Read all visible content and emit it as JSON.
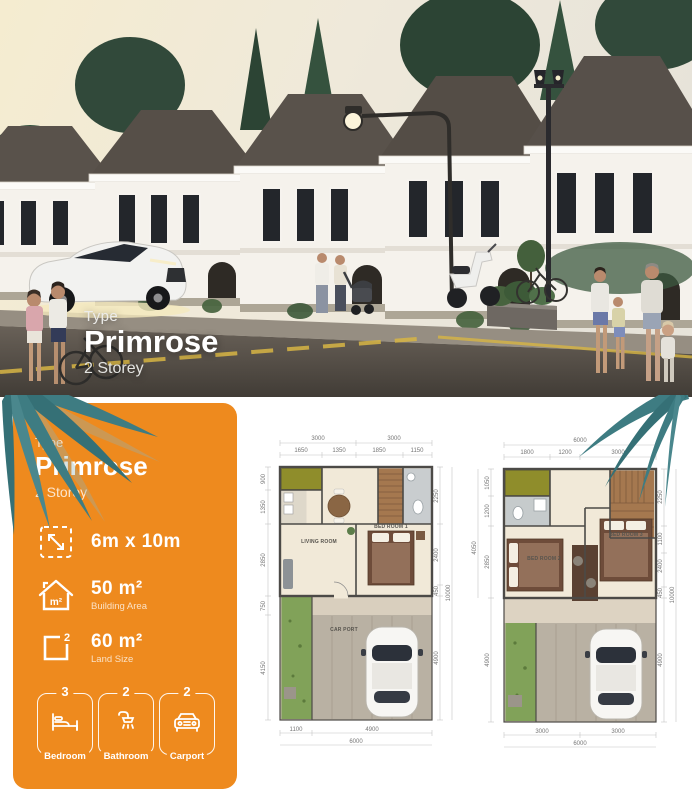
{
  "photo": {
    "overlay": {
      "type_label": "Type",
      "name": "Primrose",
      "storey": "2 Storey"
    }
  },
  "card": {
    "type_label": "Type",
    "name": "Primrose",
    "storey": "2 Storey",
    "size": {
      "value": "6m x 10m"
    },
    "building_area": {
      "value": "50 m²",
      "label": "Building Area"
    },
    "land_size": {
      "value": "60 m²",
      "label": "Land Size"
    },
    "icons": {
      "house_unit": "m²",
      "land_sup": "2"
    },
    "badges": [
      {
        "count": "3",
        "label": "Bedroom",
        "icon": "bed-icon"
      },
      {
        "count": "2",
        "label": "Bathroom",
        "icon": "shower-icon"
      },
      {
        "count": "2",
        "label": "Carport",
        "icon": "car-icon"
      }
    ],
    "colors": {
      "accent": "#EE8A1E",
      "leaf_teal": "#3E7C82"
    }
  },
  "plan1": {
    "rooms": {
      "living_room": "LIVING ROOM",
      "bed_room_1": "BED ROOM 1",
      "car_port": "CAR PORT"
    },
    "dims": {
      "top_outer": [
        "3000",
        "3000"
      ],
      "top": [
        "1650",
        "1350",
        "1850",
        "1150"
      ],
      "left": [
        "900",
        "1350",
        "2850",
        "750",
        "4150"
      ],
      "right": [
        "2250",
        "2400",
        "450",
        "4900"
      ],
      "right_outer": "10000",
      "bottom": [
        "1100",
        "4900"
      ],
      "bottom_outer": "6000"
    }
  },
  "plan2": {
    "rooms": {
      "bed_room_2": "BED ROOM 2",
      "bed_room_3": "BED ROOM 3"
    },
    "dims": {
      "top_outer": "6000",
      "top": [
        "1800",
        "1200",
        "3000"
      ],
      "left": [
        "1050",
        "1200",
        "2850",
        "4900"
      ],
      "left_outer": "4050",
      "right": [
        "2250",
        "1100",
        "2400",
        "450",
        "4900"
      ],
      "right_outer": "10000",
      "bottom": [
        "3000",
        "3000"
      ],
      "bottom_outer": "6000"
    }
  }
}
